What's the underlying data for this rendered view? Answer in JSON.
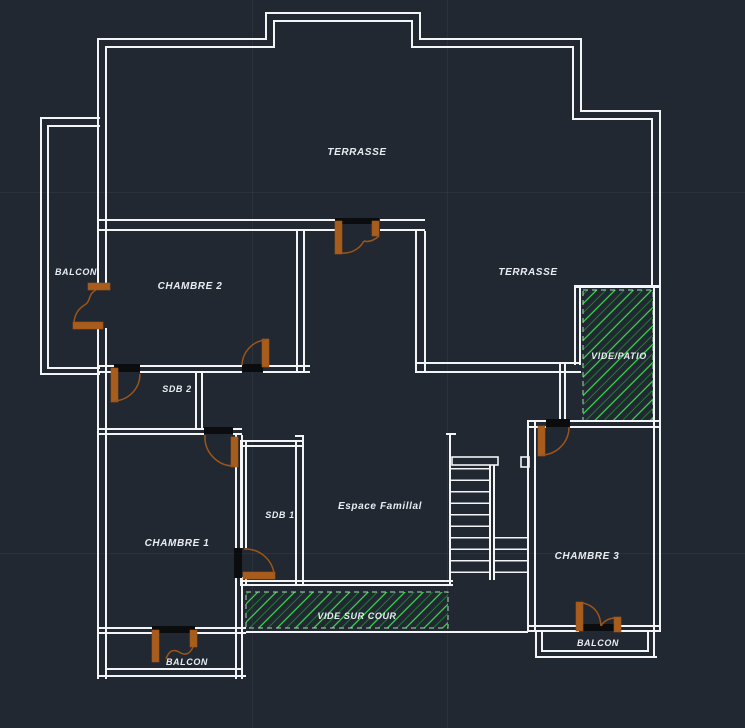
{
  "canvas": {
    "width": 745,
    "height": 728
  },
  "colors": {
    "background": "#212831",
    "wall": "#f2f4f6",
    "lintel": "#0a0c0e",
    "doorStroke": "#9c5519",
    "doorFill": "#a85d1d",
    "hatchBright": "#35e04a",
    "hatchDark": "#1c7d31",
    "hatchBorder": "#a8d8ae",
    "label": "#e9edf2",
    "grid": "rgba(255,255,255,0.05)"
  },
  "labels": {
    "terrasse_top": "TERRASSE",
    "terrasse_right": "TERRASSE",
    "balcon_left": "BALCON",
    "chambre2": "CHAMBRE 2",
    "sdb2": "SDB 2",
    "vide_patio": "VIDE/PATIO",
    "chambre1": "CHAMBRE 1",
    "sdb1": "SDB 1",
    "espace_familial": "Espace Famillal",
    "chambre3": "CHAMBRE 3",
    "vide_sur_cour": "VIDE SUR COUR",
    "balcon_bottom_left": "BALCON",
    "balcon_chambre3": "BALCON"
  }
}
